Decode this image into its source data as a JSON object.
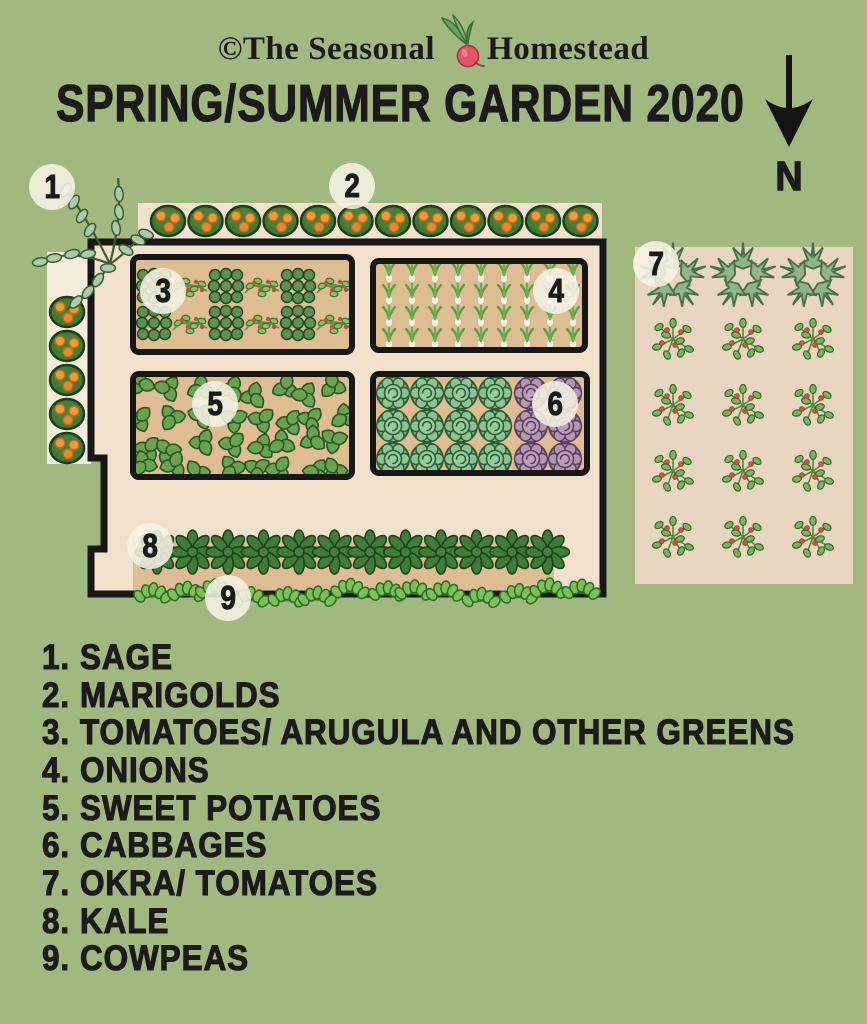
{
  "header": {
    "copyright_prefix": "©The Seasonal",
    "copyright_suffix": "Homestead",
    "title": "SPRING/SUMMER GARDEN 2020"
  },
  "compass": {
    "label": "N",
    "direction": "arrow-points-down"
  },
  "colors": {
    "background": "#a1b87f",
    "garden_tan": "#f2e1cb",
    "side_strip_tan": "#f5ecdb",
    "bed_tan": "#dfbd92",
    "right_plot_tan": "#e9d6c0",
    "outline_black": "#171717",
    "marigold_orange": "#f09a30",
    "cabbage_green": "#7cb685",
    "cabbage_purple": "#a687a7",
    "label_circle": "#f6f3e6"
  },
  "markers": [
    {
      "num": "1",
      "x": 52,
      "y": 187
    },
    {
      "num": "2",
      "x": 352,
      "y": 186
    },
    {
      "num": "3",
      "x": 163,
      "y": 291
    },
    {
      "num": "4",
      "x": 556,
      "y": 291
    },
    {
      "num": "5",
      "x": 215,
      "y": 404
    },
    {
      "num": "6",
      "x": 555,
      "y": 404
    },
    {
      "num": "7",
      "x": 656,
      "y": 264
    },
    {
      "num": "8",
      "x": 150,
      "y": 546
    },
    {
      "num": "9",
      "x": 228,
      "y": 598
    }
  ],
  "legend": {
    "items": [
      {
        "num": "1.",
        "label": "SAGE"
      },
      {
        "num": "2.",
        "label": "MARIGOLDS"
      },
      {
        "num": "3.",
        "label": "TOMATOES/ ARUGULA AND OTHER GREENS"
      },
      {
        "num": "4.",
        "label": "ONIONS"
      },
      {
        "num": "5.",
        "label": "SWEET POTATOES"
      },
      {
        "num": "6.",
        "label": "CABBAGES"
      },
      {
        "num": "7.",
        "label": "OKRA/ TOMATOES"
      },
      {
        "num": "8.",
        "label": "KALE"
      },
      {
        "num": "9.",
        "label": "COWPEAS"
      }
    ]
  },
  "garden": {
    "plantings": [
      {
        "plant": "marigold",
        "kind": "row",
        "x": 168,
        "y": 221,
        "count": 12,
        "dx": 37.5
      },
      {
        "plant": "marigold",
        "kind": "col",
        "x": 67,
        "y": 312,
        "count": 5,
        "dy": 34
      },
      {
        "plant": "greens",
        "kind": "grid",
        "x": 154,
        "y": 286,
        "cols": 3,
        "rows": 2,
        "dx": 72,
        "dy": 37,
        "clip": "b3"
      },
      {
        "plant": "tomsprawl",
        "kind": "grid",
        "x": 190,
        "y": 286,
        "cols": 3,
        "rows": 2,
        "dx": 72,
        "dy": 37,
        "clip": "b3"
      },
      {
        "plant": "onion",
        "kind": "grid",
        "x": 389,
        "y": 274,
        "cols": 9,
        "rows": 4,
        "dx": 23,
        "dy": 22,
        "clip": "b4"
      },
      {
        "plant": "spleaf",
        "kind": "grid",
        "x": 146,
        "y": 390,
        "cols": 8,
        "rows": 4,
        "dx": 27.5,
        "dy": 27,
        "jitter": 7,
        "rot": true,
        "clip": "b5"
      },
      {
        "plant": "cabg",
        "kind": "grid",
        "x": 393,
        "y": 393,
        "cols": 4,
        "rows": 3,
        "dx": 34,
        "dy": 33,
        "clip": "b6"
      },
      {
        "plant": "cabp",
        "kind": "grid",
        "x": 531,
        "y": 393,
        "cols": 2,
        "rows": 3,
        "dx": 34,
        "dy": 33,
        "clip": "b6"
      },
      {
        "plant": "kale",
        "kind": "row",
        "x": 157,
        "y": 552,
        "count": 12,
        "dx": 35.5
      },
      {
        "plant": "cowpea",
        "kind": "row",
        "x": 152,
        "y": 594,
        "count": 14,
        "dx": 33,
        "jitter": 5
      },
      {
        "plant": "okra",
        "kind": "row",
        "x": 673,
        "y": 277,
        "count": 3,
        "dx": 70
      },
      {
        "plant": "tombush",
        "kind": "grid",
        "x": 673,
        "y": 339,
        "cols": 3,
        "rows": 4,
        "dx": 70,
        "dy": 66
      }
    ]
  }
}
